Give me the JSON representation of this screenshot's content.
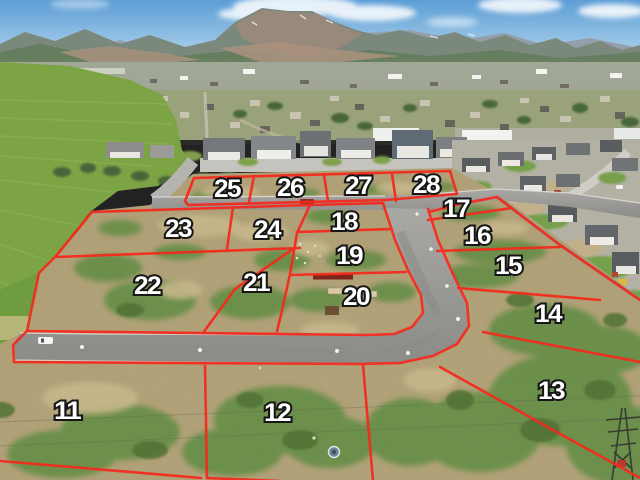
{
  "image": {
    "type": "aerial-subdivision-photo",
    "description": "Aerial drone photo of vacant subdivision lots outlined in red with painted lot numbers, new asphalt streets, surrounding neighborhoods, green pasture, a valley town and a mountain range under a blue sky",
    "annotation_color": "#f5291c",
    "label_fill": "#ffffff",
    "label_outline": "#161616"
  },
  "lots": [
    {
      "number": "11",
      "x": 67,
      "y": 419
    },
    {
      "number": "12",
      "x": 277,
      "y": 421
    },
    {
      "number": "13",
      "x": 551,
      "y": 399
    },
    {
      "number": "14",
      "x": 548,
      "y": 322
    },
    {
      "number": "15",
      "x": 508,
      "y": 274
    },
    {
      "number": "16",
      "x": 477,
      "y": 244
    },
    {
      "number": "17",
      "x": 456,
      "y": 217
    },
    {
      "number": "18",
      "x": 344,
      "y": 230
    },
    {
      "number": "19",
      "x": 349,
      "y": 264
    },
    {
      "number": "20",
      "x": 356,
      "y": 305
    },
    {
      "number": "21",
      "x": 256,
      "y": 291
    },
    {
      "number": "22",
      "x": 147,
      "y": 294
    },
    {
      "number": "23",
      "x": 178,
      "y": 237
    },
    {
      "number": "24",
      "x": 267,
      "y": 238
    },
    {
      "number": "25",
      "x": 227,
      "y": 197
    },
    {
      "number": "26",
      "x": 290,
      "y": 196
    },
    {
      "number": "27",
      "x": 358,
      "y": 194
    },
    {
      "number": "28",
      "x": 426,
      "y": 193
    }
  ]
}
